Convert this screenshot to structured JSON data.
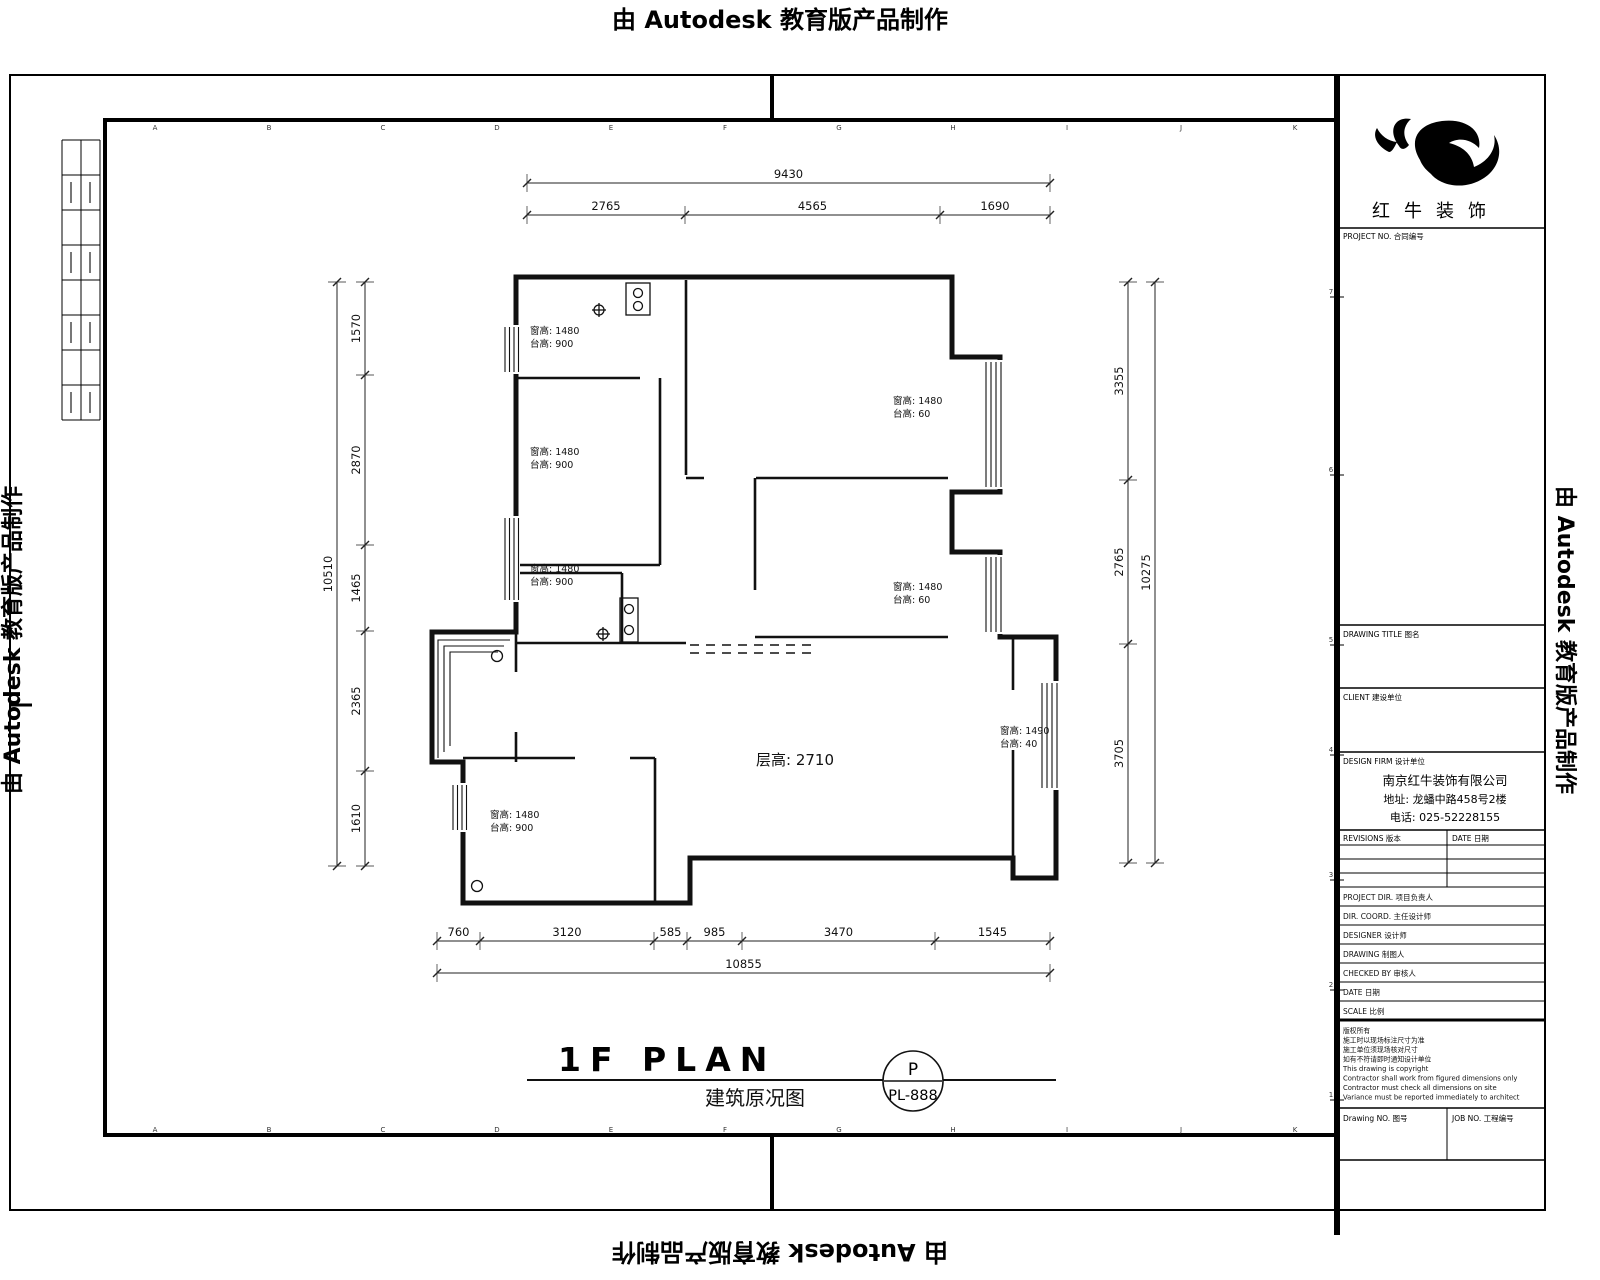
{
  "edge_banners": {
    "top": "由 Autodesk 教育版产品制作",
    "bottom": "由 Autodesk 教育版产品制作",
    "left": "由 Autodesk 教育版产品制作",
    "right": "由 Autodesk 教育版产品制作"
  },
  "grid": {
    "column_labels": [
      "A",
      "B",
      "C",
      "D",
      "E",
      "F",
      "G",
      "H",
      "I",
      "J",
      "K"
    ],
    "row_labels": [
      "7",
      "6",
      "5",
      "4",
      "3",
      "2",
      "1"
    ]
  },
  "plan": {
    "floor_height_label": "层高: 2710",
    "dims": {
      "top_total": "9430",
      "top_segments": [
        "2765",
        "4565",
        "1690"
      ],
      "bottom_segments": [
        "760",
        "3120",
        "585",
        "985",
        "3470",
        "1545"
      ],
      "bottom_total": "10855",
      "left_total": "10510",
      "left_segments": [
        "1570",
        "2870",
        "1465",
        "2365",
        "1610"
      ],
      "right_segments": [
        "3355",
        "2765",
        "3705"
      ],
      "right_total": "10275"
    },
    "window_notes": [
      {
        "line1": "窗高: 1480",
        "line2": "台高: 900"
      },
      {
        "line1": "窗高: 1480",
        "line2": "台高: 900"
      },
      {
        "line1": "窗高: 1480",
        "line2": "台高: 900"
      },
      {
        "line1": "窗高: 1480",
        "line2": "台高: 60"
      },
      {
        "line1": "窗高: 1480",
        "line2": "台高: 60"
      },
      {
        "line1": "窗高: 1490",
        "line2": "台高: 40"
      },
      {
        "line1": "窗高: 1480",
        "line2": "台高: 900"
      }
    ]
  },
  "title": {
    "main": "1F PLAN",
    "sub": "建筑原况图",
    "badge_letter": "P",
    "badge_code": "PL-888"
  },
  "title_block": {
    "brand": "红牛装饰",
    "project_no_label": "PROJECT NO. 合同编号",
    "drawing_title_label": "DRAWING TITLE 图名",
    "client_label": "CLIENT 建设单位",
    "design_firm_label": "DESIGN FIRM 设计单位",
    "company_name": "南京红牛装饰有限公司",
    "company_address": "地址: 龙蟠中路458号2楼",
    "company_phone": "电话: 025-52228155",
    "revisions_label": "REVISIONS 版本",
    "date_col_label": "DATE 日期",
    "personnel_rows": [
      "PROJECT DIR. 项目负责人",
      "DIR. COORD. 主任设计师",
      "DESIGNER 设计师",
      "DRAWING 制图人",
      "CHECKED BY 审核人",
      "DATE 日期",
      "SCALE 比例"
    ],
    "notes": [
      "版权所有",
      "施工时以现场标注尺寸为准",
      "施工单位须现场核对尺寸",
      "如有不符请即时通知设计单位",
      "This drawing is copyright",
      "Contractor shall work from figured dimensions only",
      "Contractor must check all dimensions on site",
      "Variance must be reported immediately to architect"
    ],
    "drawing_no_label": "Drawing NO. 图号",
    "job_no_label": "JOB NO. 工程编号"
  }
}
